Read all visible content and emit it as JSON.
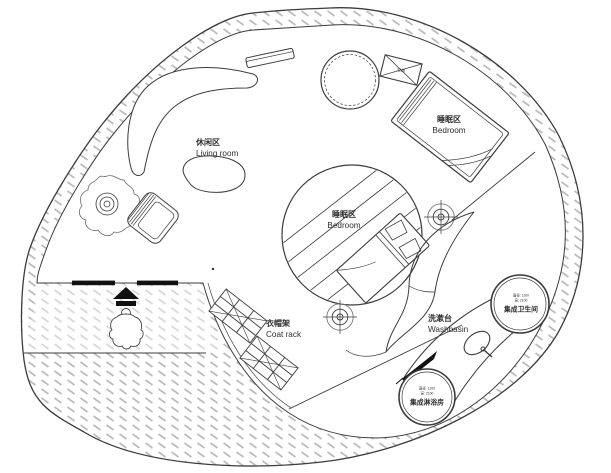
{
  "drawing": {
    "type": "residential-floor-plan",
    "shape": "round-nautilus-house"
  },
  "colors": {
    "paper": "#ffffff",
    "line": "#3c3c3c",
    "light_line": "#8a8a8a",
    "hatch": "#bcbcbc",
    "black_fill": "#111111"
  },
  "areas": {
    "living": {
      "zh": "休闲区",
      "en": "Living room"
    },
    "bedroom_upper": {
      "zh": "睡眠区",
      "en": "Bedroom"
    },
    "bedroom_center": {
      "zh": "睡眠区",
      "en": "Bedroom"
    },
    "coat_rack": {
      "zh": "衣帽架",
      "en": "Coat rack"
    },
    "washbasin": {
      "zh": "洗漱台",
      "en": "Washbasin"
    },
    "bathroom_pod": {
      "name": "集成卫生间",
      "dim_line1": "直径: 1100",
      "dim_line2": "高: 2100"
    },
    "shower_pod": {
      "name": "集成淋浴房",
      "dim_line1": "直径: 1100",
      "dim_line2": "高: 2100"
    },
    "equipment_box": {
      "label": "空调"
    }
  },
  "symbols": {
    "ceiling_marker": "crosshair-target",
    "sink": "oval-basin-with-tap",
    "person": "person-top-view",
    "entry_arrow": "black-direction-arrow",
    "door_threshold": "black-bars",
    "wall_fill": "diagonal-dash-hatch",
    "plant": "potted-plant"
  }
}
